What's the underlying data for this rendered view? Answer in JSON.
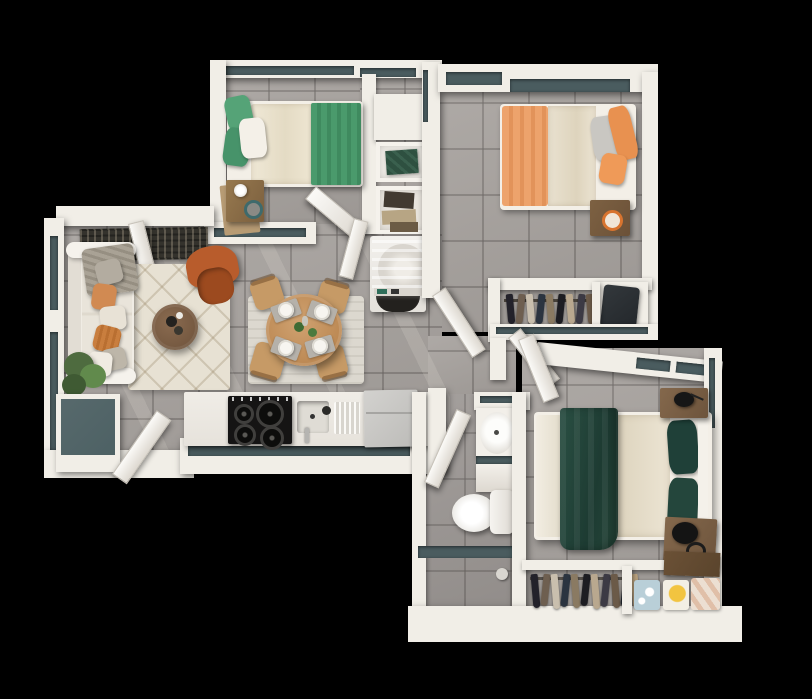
{
  "scene": {
    "kind": "3d-apartment-floor-plan",
    "view": "top-down axonometric render",
    "background": "#000000",
    "text_visible": false
  },
  "palette": {
    "bg": "#000000",
    "wall": "#f1eee7",
    "wall-shade": "#d7d2ca",
    "glass": "#4a5c5f",
    "floor": "#a7a29e",
    "floor-dark": "#9c9794",
    "rug-cream": "#e7e1d3",
    "rug-dining": "#dcd8cf",
    "runner": "#34322c",
    "sofa": "#f0ece4",
    "cushion": "#e9e4da",
    "armchair": "#b85c2c",
    "armchair-dark": "#9c4a1f",
    "plant": "#4e6b3f",
    "plant-light": "#618a4c",
    "planter-top": "#4d6164",
    "wood-light": "#c69a66",
    "wood-mid": "#8d7254",
    "wood-dark": "#7a5f46",
    "walnut": "#7c5f46",
    "bed-cream": "#ebe3d0",
    "sheet": "#f3efe7",
    "green": "#4a9a6c",
    "green-deep": "#2a4f43",
    "green-pillow": "#1f4038",
    "orange-bed": "#eda36c",
    "orange-pillow": "#e89150",
    "pillow-gray": "#b3aca0",
    "pillow-rust": "#c97e3e",
    "stove": "#151414",
    "fridge": "#c9c8c5",
    "washer-door": "#23211e",
    "teal-accent": "#2f6e5a",
    "linen-blue": "#b9cfd8",
    "linen-yellow": "#f2c440",
    "linen-pink": "#e0bfa8",
    "lamp": "#161616",
    "rod": "#4a443c",
    "tan-rug": "#b79b74"
  },
  "rooms": [
    {
      "name": "bedroom-small",
      "furniture": [
        "single-bed-green",
        "green-pillows",
        "desk",
        "desk-lamp",
        "desk-rug",
        "wardrobe-shelves",
        "door",
        "window"
      ]
    },
    {
      "name": "laundry-nook",
      "furniture": [
        "washer",
        "linen-shelves",
        "folded-towels"
      ]
    },
    {
      "name": "bedroom-orange",
      "furniture": [
        "single-bed-orange",
        "nightstand",
        "closet-hanging-clothes",
        "suitcase",
        "door",
        "windows"
      ]
    },
    {
      "name": "living-room",
      "furniture": [
        "sofa",
        "throw-pillows",
        "throw-blanket",
        "armchair",
        "coffee-table",
        "area-rug",
        "entry-runner",
        "floor-plant",
        "planter-cabinet",
        "entry-door",
        "windows"
      ]
    },
    {
      "name": "dining-area",
      "furniture": [
        "round-table",
        "chairs",
        "placemats",
        "plates",
        "centerpiece-plants",
        "rug"
      ],
      "chair_count": 4,
      "place_settings": 4
    },
    {
      "name": "kitchen",
      "furniture": [
        "counter",
        "gas-stove",
        "sink",
        "faucet",
        "dish-rack",
        "refrigerator",
        "window-strip"
      ],
      "burner_count": 4
    },
    {
      "name": "bathroom",
      "furniture": [
        "vanity-sink",
        "vanity-cabinet",
        "toilet",
        "shower-partition",
        "door"
      ]
    },
    {
      "name": "master-bedroom",
      "furniture": [
        "double-bed",
        "green-throw-blanket",
        "green-pillows",
        "nightstand-left",
        "nightstand-right",
        "black-lamps",
        "closet-hanging-clothes",
        "folded-linens",
        "storage-box",
        "door",
        "windows"
      ]
    }
  ]
}
